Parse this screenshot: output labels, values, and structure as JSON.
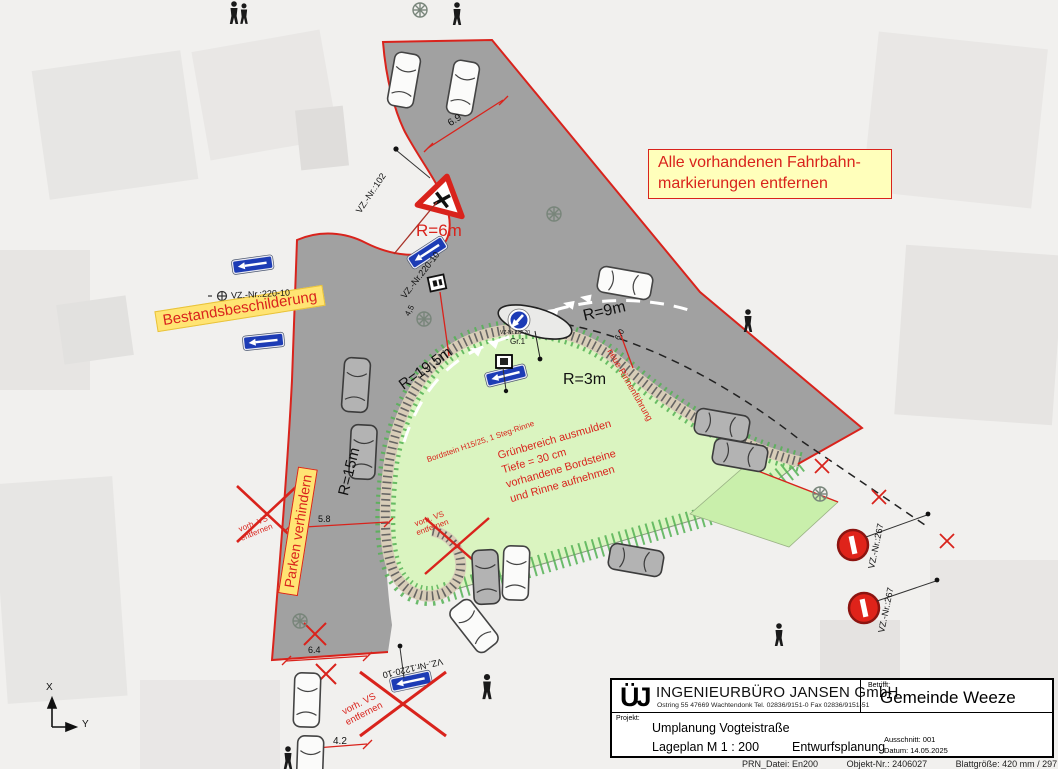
{
  "note_box": {
    "line1": "Alle vorhandenen Fahrbahn-",
    "line2": "markierungen entfernen"
  },
  "labels": {
    "bestand": "Bestandsbeschilderung",
    "parken": "Parken verhindern",
    "gruen1": "Grünbereich ausmulden",
    "gruen2": "Tiefe = 30 cm",
    "gruen3": "vorhandene Bordsteine",
    "gruen4": "und Rinne aufnehmen",
    "bordstein": "Bordstein H15/25, 1 Steg-Rinne",
    "rinne": "neue Rinnenführung",
    "vs_line1": "vorh. VS",
    "vs_line2": "entfernen"
  },
  "radii": {
    "r6": "R=6m",
    "r9": "R=9m",
    "r195": "R=19,5m",
    "r3": "R=3m",
    "r15": "R=15m"
  },
  "signs": {
    "vz102": "VZ.-Nr.:102",
    "vz220": "VZ.-Nr.:220-10",
    "vz220b": "VZ.-Nr.220-10",
    "vz1220": "VZ.-Nr.1220-10",
    "vz267": "VZ.-Nr.:267",
    "vz222": "VZ-Nr.222-20",
    "gr1": "Gr.1"
  },
  "dims": {
    "d69": "6.9",
    "d45": "4,5",
    "d58": "5.8",
    "d64": "6.4",
    "d42": "4.2",
    "d60": "6,0"
  },
  "axis": {
    "x": "X",
    "y": "Y"
  },
  "titleblock": {
    "logo": "ÜJ",
    "company": "INGENIEURBÜRO JANSEN GmbH",
    "address": "Ostring 55  47669 Wachtendonk  Tel. 02836/9151-0  Fax 02836/9151-51",
    "betrifft_label": "Betrifft:",
    "betrifft": "Gemeinde Weeze",
    "projekt_label": "Projekt:",
    "projekt": "Umplanung  Vogteistraße",
    "plan": "Lageplan   M 1 : 200",
    "phase": "Entwurfsplanung",
    "ausschnitt": "Ausschnitt: 001",
    "datum": "Datum:      14.05.2025",
    "footer1": "PRN_Datei: En200",
    "footer2": "Objekt-Nr.: 2406027",
    "footer3": "Blattgröße: 420 mm   /  297 mm"
  },
  "colors": {
    "road": "#9c9c9c",
    "edge_red": "#d9231c",
    "green": "#daf4c0",
    "green2": "#c9efab",
    "curb": "#d8cdb8",
    "sign_blue": "#1d3cb5",
    "note_yellow": "#ffffbb"
  }
}
